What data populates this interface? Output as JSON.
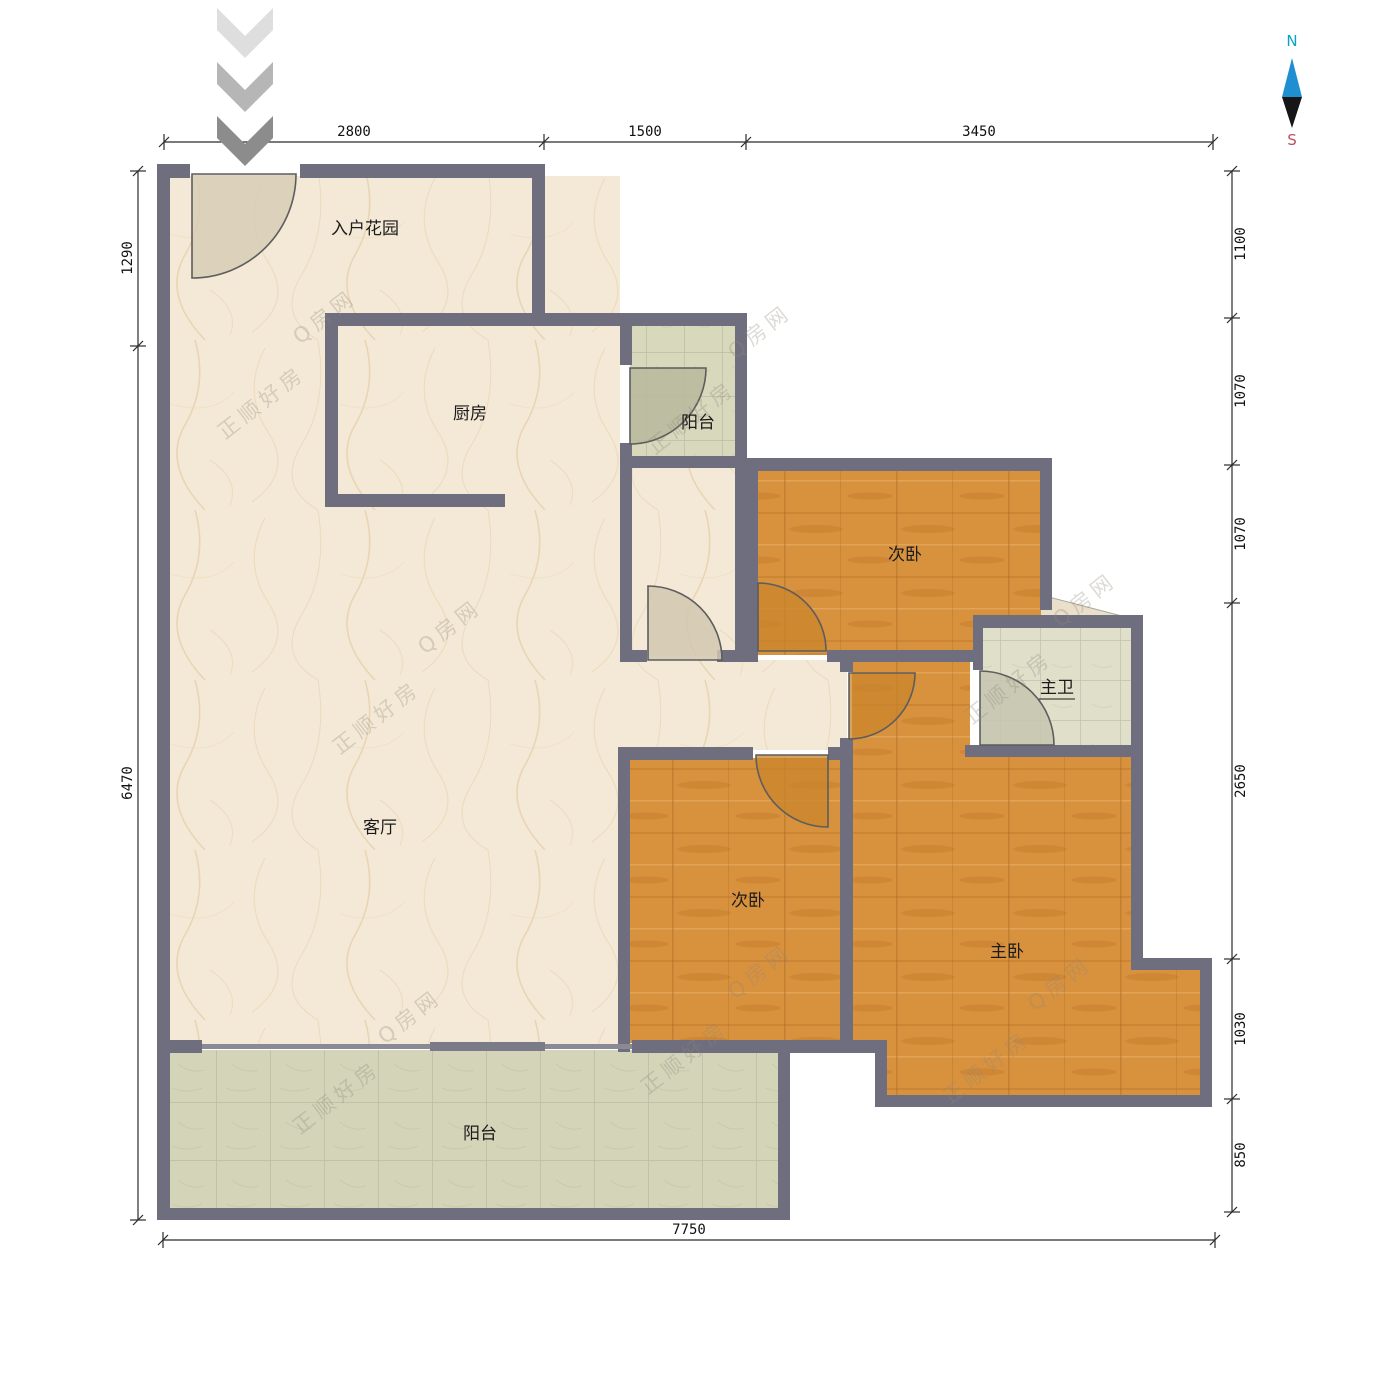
{
  "compass": {
    "north": "N",
    "south": "S"
  },
  "rooms": [
    {
      "id": "entry-garden",
      "label": "入户花园"
    },
    {
      "id": "kitchen",
      "label": "厨房"
    },
    {
      "id": "balcony-north",
      "label": "阳台"
    },
    {
      "id": "bedroom-second-north",
      "label": "次卧"
    },
    {
      "id": "master-bath",
      "label": "主卫"
    },
    {
      "id": "living-room",
      "label": "客厅"
    },
    {
      "id": "bedroom-second-south",
      "label": "次卧"
    },
    {
      "id": "master-bedroom",
      "label": "主卧"
    },
    {
      "id": "balcony-south",
      "label": "阳台"
    }
  ],
  "dimensions": {
    "top": [
      "2800",
      "1500",
      "3450"
    ],
    "left": [
      "1290",
      "6470"
    ],
    "right": [
      "1100",
      "1070",
      "1070",
      "2650",
      "1030",
      "850"
    ],
    "bottom": [
      "7750"
    ]
  },
  "watermarks": {
    "brand": "正顺好房",
    "site": "Q房网"
  },
  "colors": {
    "wall": "#6e6e7e",
    "marble_floor": "#f4e9d6",
    "wood_floor": "#d8923e",
    "tile_floor": "#d6d6ba",
    "north_label": "#0aa3c4",
    "south_label": "#bb4f5d",
    "compass_blue": "#1e8fd0",
    "compass_black": "#161616"
  }
}
